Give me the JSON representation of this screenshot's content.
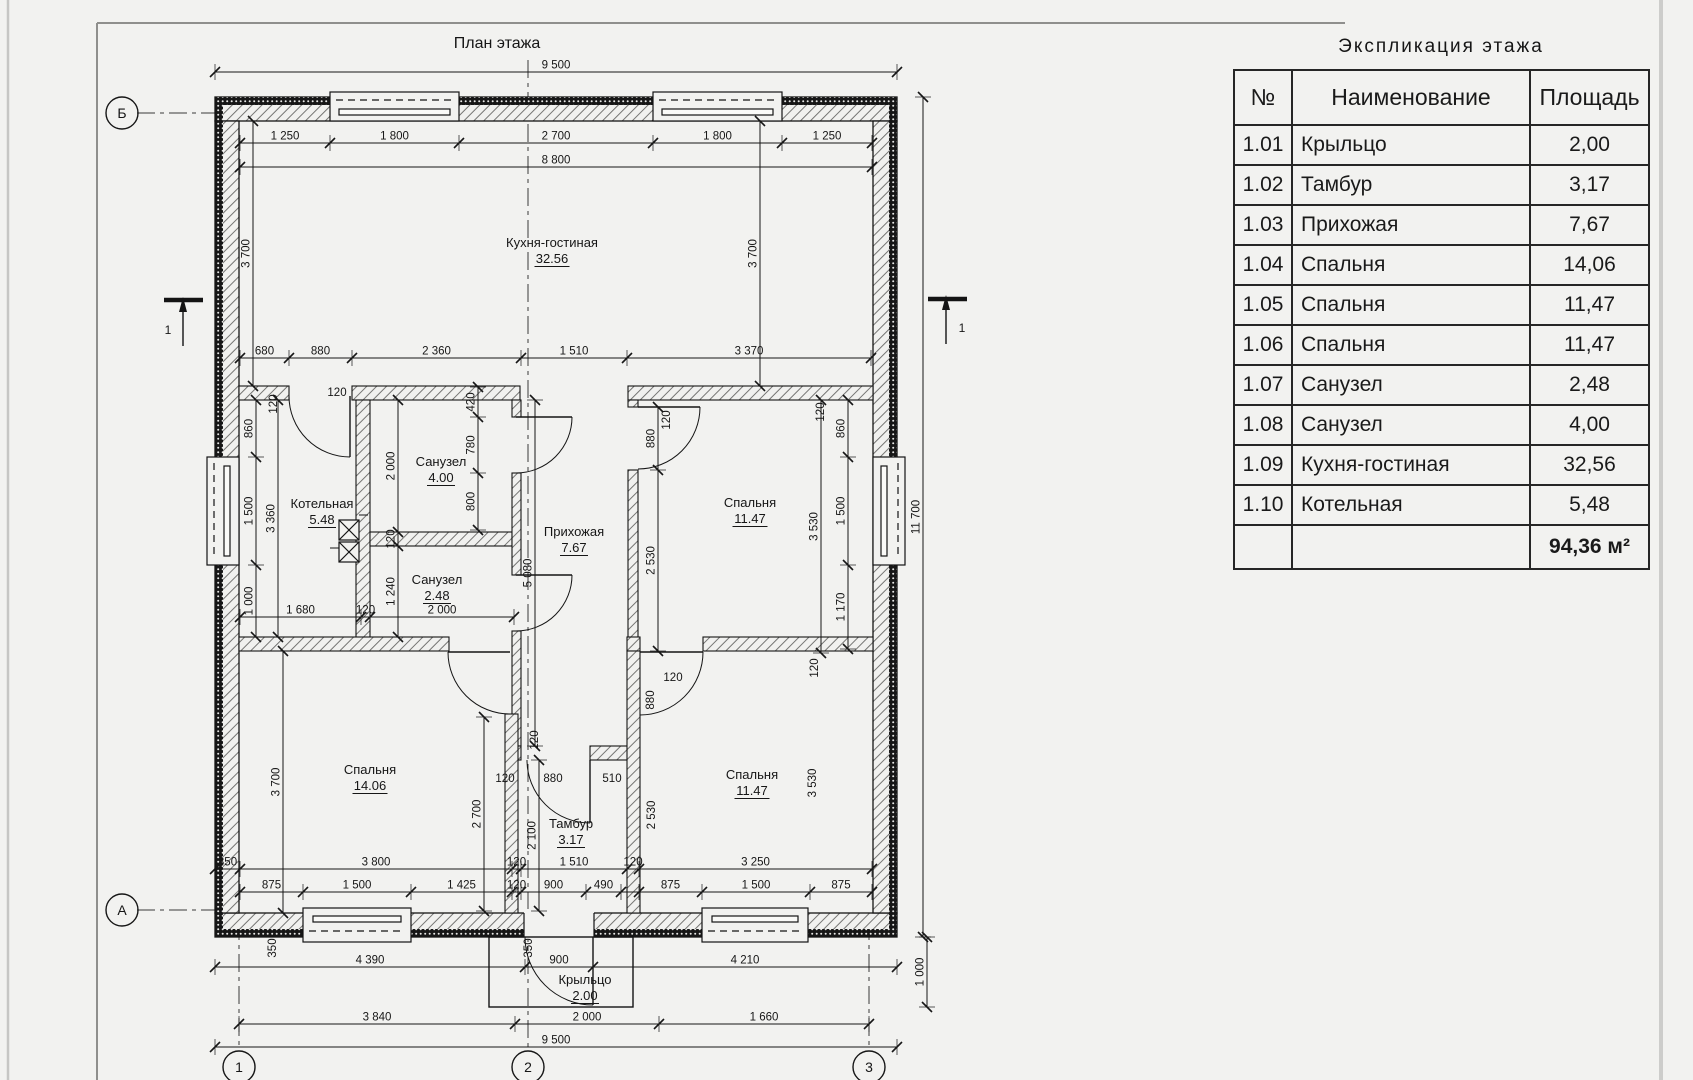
{
  "page": {
    "background": "#f2f2f0",
    "line_color": "#161616"
  },
  "plan": {
    "title": "План этажа",
    "rooms": [
      {
        "name": "Кухня-гостиная",
        "area": "32.56",
        "x": 552,
        "y": 247
      },
      {
        "name": "Котельная",
        "area": "5.48",
        "x": 322,
        "y": 508
      },
      {
        "name": "Санузел",
        "area": "4.00",
        "x": 441,
        "y": 466
      },
      {
        "name": "Санузел",
        "area": "2.48",
        "x": 437,
        "y": 584
      },
      {
        "name": "Прихожая",
        "area": "7.67",
        "x": 574,
        "y": 536
      },
      {
        "name": "Спальня",
        "area": "11.47",
        "x": 750,
        "y": 507
      },
      {
        "name": "Спальня",
        "area": "14.06",
        "x": 370,
        "y": 774
      },
      {
        "name": "Тамбур",
        "area": "3.17",
        "x": 571,
        "y": 828
      },
      {
        "name": "Спальня",
        "area": "11.47",
        "x": 752,
        "y": 779
      },
      {
        "name": "Крыльцо",
        "area": "2.00",
        "x": 585,
        "y": 984
      }
    ],
    "dim_chains": [
      {
        "o": "h",
        "y": 72,
        "b": [
          215,
          897
        ],
        "l": [
          "9 500"
        ]
      },
      {
        "o": "h",
        "y": 143,
        "b": [
          240,
          330,
          459,
          653,
          782,
          872
        ],
        "l": [
          "1 250",
          "1 800",
          "2 700",
          "1 800",
          "1 250"
        ]
      },
      {
        "o": "h",
        "y": 167,
        "b": [
          240,
          872
        ],
        "l": [
          "8 800"
        ]
      },
      {
        "o": "h",
        "y": 358,
        "b": [
          240,
          289,
          352,
          521,
          627,
          871
        ],
        "l": [
          "680",
          "880",
          "2 360",
          "1 510",
          "3 370"
        ]
      },
      {
        "o": "h",
        "y": 617,
        "b": [
          240,
          361,
          370,
          514
        ],
        "l": [
          "1 680",
          "120",
          "2 000"
        ]
      },
      {
        "o": "h",
        "y": 869,
        "b": [
          215,
          240,
          512,
          521,
          627,
          639,
          872
        ],
        "l": [
          "350",
          "3 800",
          "120",
          "1 510",
          "120",
          "3 250"
        ]
      },
      {
        "o": "h",
        "y": 892,
        "b": [
          240,
          303,
          411,
          512,
          521,
          586,
          621,
          639,
          702,
          810,
          872
        ],
        "l": [
          "875",
          "1 500",
          "1 425",
          "120",
          "900",
          "490",
          "",
          "875",
          "1 500",
          "875"
        ]
      },
      {
        "o": "h",
        "y": 967,
        "b": [
          215,
          525,
          593,
          897
        ],
        "l": [
          "4 390",
          "900",
          "4 210"
        ]
      },
      {
        "o": "h",
        "y": 1024,
        "b": [
          239,
          515,
          659,
          869
        ],
        "l": [
          "3 840",
          "2 000",
          "1 660"
        ]
      },
      {
        "o": "h",
        "y": 1047,
        "b": [
          215,
          897
        ],
        "l": [
          "9 500"
        ]
      },
      {
        "o": "v",
        "x": 253,
        "b": [
          121,
          386
        ],
        "l": [
          "3 700"
        ]
      },
      {
        "o": "v",
        "x": 760,
        "b": [
          121,
          386
        ],
        "l": [
          "3 700"
        ]
      },
      {
        "o": "v",
        "x": 256,
        "b": [
          400,
          457,
          565,
          637
        ],
        "l": [
          "860",
          "1 500",
          "1 000"
        ]
      },
      {
        "o": "v",
        "x": 278,
        "b": [
          400,
          637
        ],
        "l": [
          "3 360"
        ]
      },
      {
        "o": "v",
        "x": 283,
        "b": [
          651,
          913
        ],
        "l": [
          "3 700"
        ]
      },
      {
        "o": "v",
        "x": 398,
        "b": [
          400,
          532,
          546,
          637
        ],
        "l": [
          "2 000",
          "120",
          "1 240"
        ]
      },
      {
        "o": "v",
        "x": 478,
        "b": [
          387,
          417,
          473,
          530
        ],
        "l": [
          "420",
          "780",
          "800"
        ]
      },
      {
        "o": "v",
        "x": 848,
        "b": [
          400,
          457,
          565,
          649
        ],
        "l": [
          "860",
          "1 500",
          "1 170"
        ]
      },
      {
        "o": "v",
        "x": 923,
        "b": [
          97,
          937
        ],
        "l": [
          "11 700"
        ]
      },
      {
        "o": "v",
        "x": 484,
        "b": [
          717,
          911
        ],
        "l": [
          "2 700"
        ]
      },
      {
        "o": "v",
        "x": 539,
        "b": [
          760,
          911
        ],
        "l": [
          "2 100"
        ]
      },
      {
        "o": "v",
        "x": 658,
        "b": [
          407,
          470,
          651
        ],
        "l": [
          "880",
          "2 530"
        ]
      },
      {
        "o": "v",
        "x": 821,
        "b": [
          400,
          653
        ],
        "l": [
          "3 530"
        ]
      },
      {
        "o": "v",
        "x": 535,
        "b": [
          400,
          746
        ],
        "l": [
          "5 080"
        ]
      },
      {
        "o": "v",
        "x": 927,
        "b": [
          937,
          1007
        ],
        "l": [
          "1 000"
        ]
      }
    ],
    "loose_dims": [
      {
        "t": "120",
        "x": 277,
        "y": 404,
        "r": 1
      },
      {
        "t": "120",
        "x": 337,
        "y": 396,
        "r": 0
      },
      {
        "t": "120",
        "x": 824,
        "y": 412,
        "r": 1
      },
      {
        "t": "120",
        "x": 670,
        "y": 420,
        "r": 1
      },
      {
        "t": "120",
        "x": 538,
        "y": 740,
        "r": 1
      },
      {
        "t": "120",
        "x": 505,
        "y": 782,
        "r": 0
      },
      {
        "t": "880",
        "x": 553,
        "y": 782,
        "r": 0
      },
      {
        "t": "510",
        "x": 612,
        "y": 782,
        "r": 0
      },
      {
        "t": "350",
        "x": 532,
        "y": 948,
        "r": 1
      },
      {
        "t": "350",
        "x": 276,
        "y": 948,
        "r": 1
      },
      {
        "t": "880",
        "x": 654,
        "y": 700,
        "r": 1
      },
      {
        "t": "120",
        "x": 673,
        "y": 681,
        "r": 0
      },
      {
        "t": "2 530",
        "x": 655,
        "y": 815,
        "r": 1
      },
      {
        "t": "3 530",
        "x": 816,
        "y": 783,
        "r": 1
      },
      {
        "t": "120",
        "x": 818,
        "y": 668,
        "r": 1
      }
    ],
    "axes": [
      {
        "label": "Б",
        "x": 122,
        "y": 113
      },
      {
        "label": "А",
        "x": 122,
        "y": 910
      },
      {
        "label": "1",
        "x": 239,
        "y": 1067
      },
      {
        "label": "2",
        "x": 528,
        "y": 1067
      },
      {
        "label": "3",
        "x": 869,
        "y": 1067
      }
    ],
    "section_marks": [
      {
        "label": "1",
        "x": 168,
        "y": 334
      },
      {
        "label": "1",
        "x": 962,
        "y": 332
      }
    ]
  },
  "table": {
    "title": "Экспликация этажа",
    "headers": [
      "№",
      "Наименование",
      "Площадь"
    ],
    "rows": [
      {
        "num": "1.01",
        "name": "Крыльцо",
        "area": "2,00"
      },
      {
        "num": "1.02",
        "name": "Тамбур",
        "area": "3,17"
      },
      {
        "num": "1.03",
        "name": "Прихожая",
        "area": "7,67"
      },
      {
        "num": "1.04",
        "name": "Спальня",
        "area": "14,06"
      },
      {
        "num": "1.05",
        "name": "Спальня",
        "area": "11,47"
      },
      {
        "num": "1.06",
        "name": "Спальня",
        "area": "11,47"
      },
      {
        "num": "1.07",
        "name": "Санузел",
        "area": "2,48"
      },
      {
        "num": "1.08",
        "name": "Санузел",
        "area": "4,00"
      },
      {
        "num": "1.09",
        "name": "Кухня-гостиная",
        "area": "32,56"
      },
      {
        "num": "1.10",
        "name": "Котельная",
        "area": "5,48"
      }
    ],
    "total": "94,36 м²"
  }
}
